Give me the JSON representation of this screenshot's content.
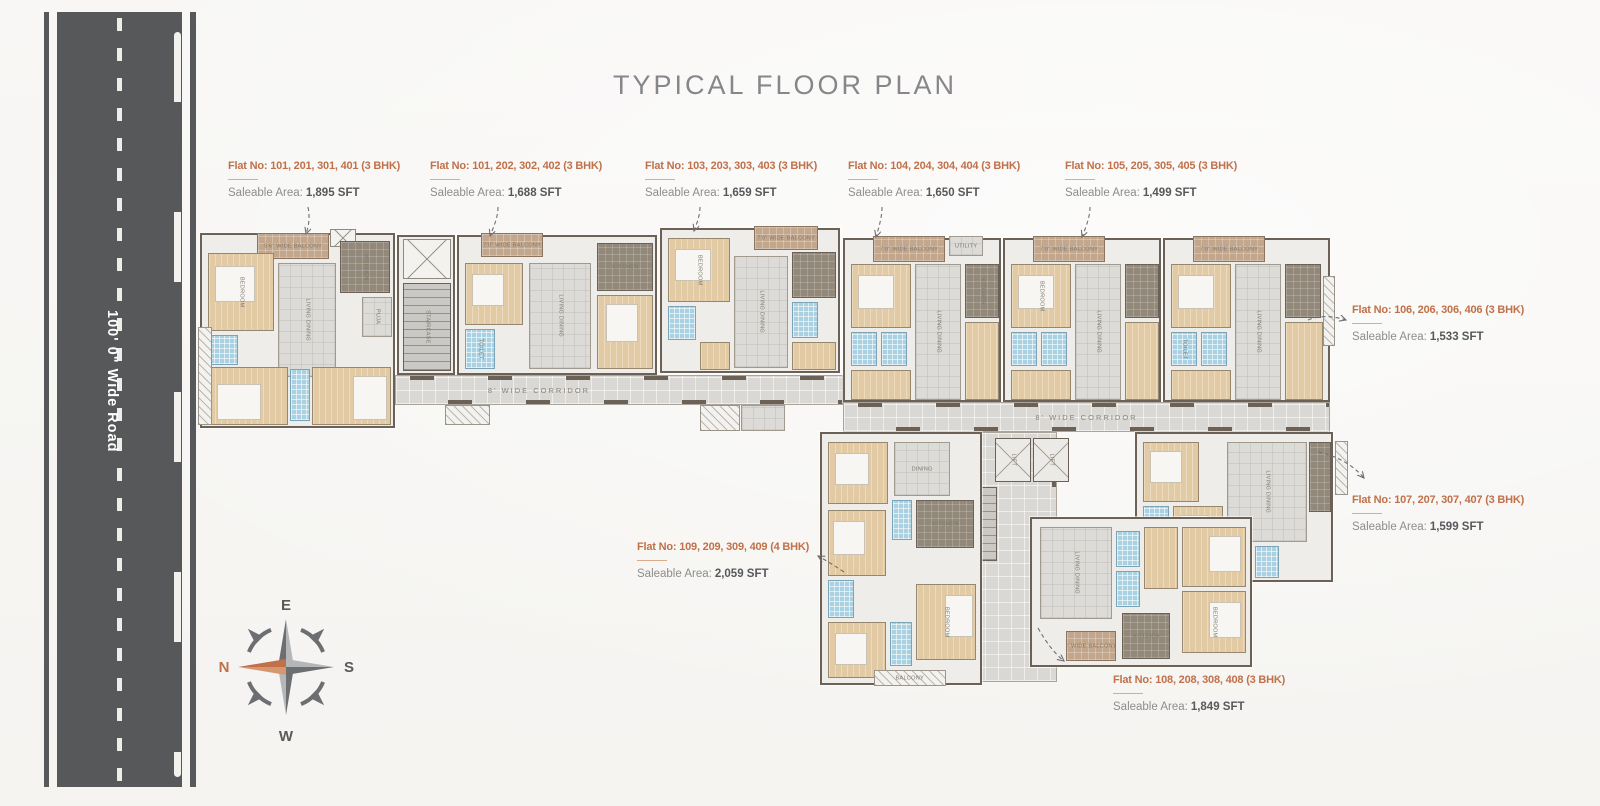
{
  "title": "TYPICAL FLOOR PLAN",
  "road": {
    "label": "100' 0\" Wide Road"
  },
  "compass": {
    "n": "N",
    "e": "E",
    "s": "S",
    "w": "W"
  },
  "colors": {
    "accent_orange": "#c0714a",
    "road_gray": "#57585a",
    "wall": "#6b6156",
    "room_beige": "#e2cba4",
    "toilet_blue": "#a9d1e1",
    "title_gray": "#85878a"
  },
  "flats": [
    {
      "title": "Flat No: 101, 201, 301, 401 (3 BHK)",
      "area_label": "Saleable Area:",
      "area_value": "1,895 SFT"
    },
    {
      "title": "Flat No: 101, 202, 302, 402 (3 BHK)",
      "area_label": "Saleable Area:",
      "area_value": "1,688 SFT"
    },
    {
      "title": "Flat No: 103, 203, 303, 403 (3 BHK)",
      "area_label": "Saleable Area:",
      "area_value": "1,659 SFT"
    },
    {
      "title": "Flat No: 104, 204, 304, 404 (3 BHK)",
      "area_label": "Saleable Area:",
      "area_value": "1,650 SFT"
    },
    {
      "title": "Flat No: 105, 205, 305, 405 (3 BHK)",
      "area_label": "Saleable Area:",
      "area_value": "1,499 SFT"
    },
    {
      "title": "Flat No: 106, 206, 306, 406 (3 BHK)",
      "area_label": "Saleable Area:",
      "area_value": "1,533 SFT"
    },
    {
      "title": "Flat No: 107, 207, 307, 407 (3 BHK)",
      "area_label": "Saleable Area:",
      "area_value": "1,599 SFT"
    },
    {
      "title": "Flat No: 108, 208, 308, 408 (3 BHK)",
      "area_label": "Saleable Area:",
      "area_value": "1,849 SFT"
    },
    {
      "title": "Flat No: 109, 209, 309, 409 (4 BHK)",
      "area_label": "Saleable Area:",
      "area_value": "2,059 SFT"
    }
  ],
  "plan": {
    "corridor_label": "8' WIDE CORRIDOR",
    "rooms": {
      "bedroom": "BEDROOM",
      "toilet": "TOILET",
      "kitchen": "KITCHEN",
      "living_dining": "LIVING DINING",
      "dining": "DINING",
      "puja": "PUJA",
      "foyer": "FOYER",
      "lift": "LIFT",
      "up": "UP",
      "staircase": "STAIRCASE",
      "utility": "UTILITY",
      "balcony": "BALCONY",
      "balcony70": "7'0\" WIDE BALCONY",
      "balcony56": "5'6\" WIDE BALCONY",
      "balcony9": "9' WIDE BALCONY"
    }
  }
}
